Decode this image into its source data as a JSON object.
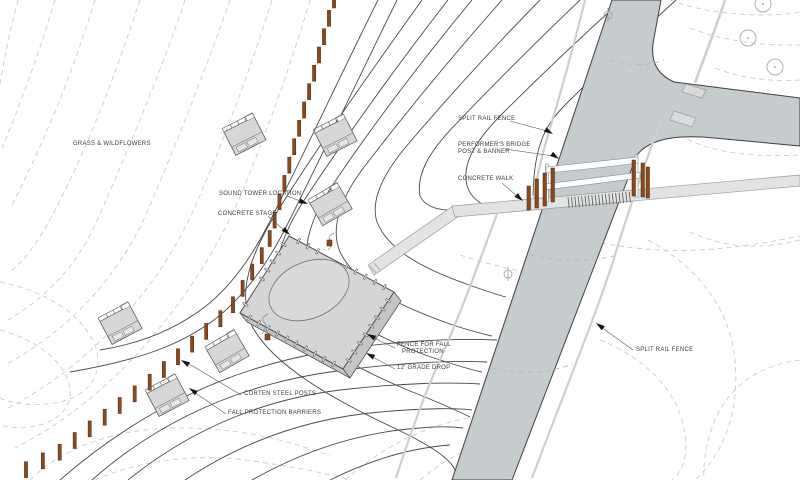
{
  "title": "Site plan diagram",
  "annotations": {
    "grass": {
      "label": "GRASS & WILDFLOWERS"
    },
    "sound_tower": {
      "label": "SOUND TOWER LOCATION"
    },
    "concrete_stage": {
      "label": "CONCRETE STAGE"
    },
    "split_rail_top": {
      "label": "SPLIT RAIL FENCE"
    },
    "performers_bridge": {
      "label_line1": "PERFORMER'S BRIDGE",
      "label_line2": "POST & BANNER"
    },
    "concrete_walk": {
      "label": "CONCRETE WALK"
    },
    "fence_fall": {
      "label_line1": "FENCE FOR FALL",
      "label_line2": "PROTECTION"
    },
    "grade_drop": {
      "label": "12' GRADE DROP"
    },
    "corten_posts": {
      "label": "CORTEN STEEL POSTS"
    },
    "fall_barriers": {
      "label": "FALL PROTECTION BARRIERS"
    },
    "split_rail_bottom": {
      "label": "SPLIT RAIL FENCE"
    }
  },
  "colors": {
    "corten": "#8a4a1e",
    "corten_outline": "#4a2408",
    "road": "#c6cbce",
    "walk": "#e2e3e4",
    "stage_top": "#d3d5d7",
    "stage_side": "#c3c5c7",
    "contour_dashed": "#c7c7c7",
    "contour_solid": "#4a4a4a",
    "fence_line": "#cfcfcf",
    "label_text": "#3d3d3d"
  }
}
